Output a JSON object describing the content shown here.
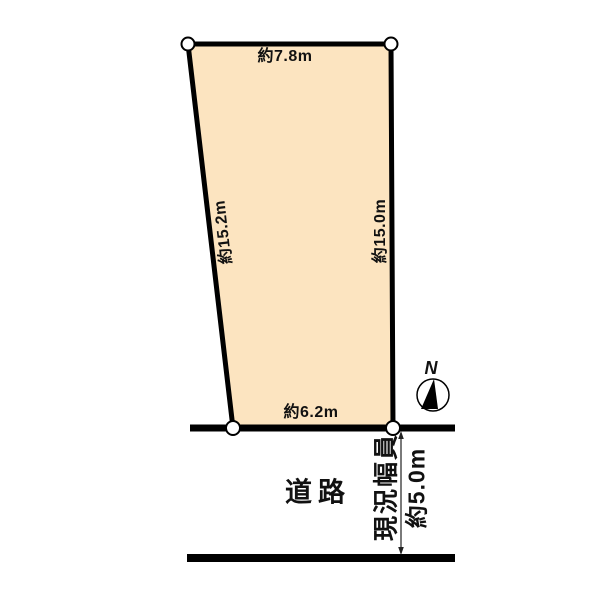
{
  "diagram": {
    "type": "land-plot-survey",
    "plot": {
      "fill_color": "#fce4c0",
      "line_color": "#000000",
      "dimensions": {
        "top": "約7.8m",
        "left": "約15.2m",
        "right": "約15.0m",
        "bottom": "約6.2m"
      }
    },
    "road": {
      "label": "道路",
      "width_label": "現況幅員",
      "width_value": "約5.0m"
    },
    "compass": {
      "label": "N"
    }
  }
}
